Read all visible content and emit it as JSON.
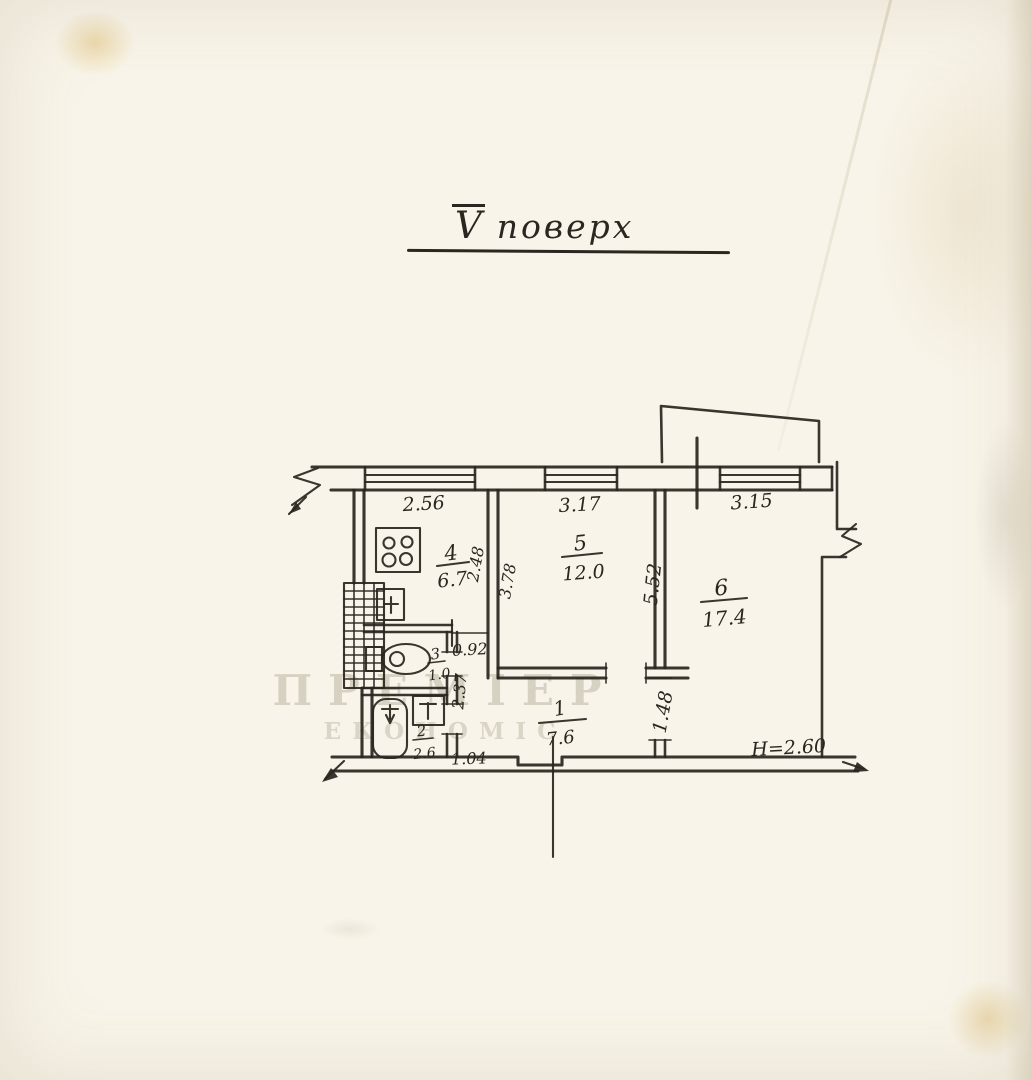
{
  "plan": {
    "floor_numeral": "V",
    "floor_word": "поверх",
    "rooms": {
      "r1": {
        "number": "1",
        "area": "7.6"
      },
      "r2": {
        "number": "2",
        "area": "2.6"
      },
      "r3": {
        "number": "3",
        "area": "1.0"
      },
      "r4": {
        "number": "4",
        "area": "6.7"
      },
      "r5": {
        "number": "5",
        "area": "12.0"
      },
      "r6": {
        "number": "6",
        "area": "17.4"
      }
    },
    "dims": {
      "win_kitchen": "2.56",
      "win_room5": "3.17",
      "win_room6": "3.15",
      "kitchen_depth": "2.48",
      "room5_depth": "3.78",
      "room6_side": "5.52",
      "door_room6": "1.48",
      "corridor_width": "0.92",
      "corridor_length": "2.37",
      "vestibule": "1.04",
      "ceiling_height": "H=2.60"
    },
    "watermark": {
      "line1": "ПРЕМІЕР",
      "line2": "ЕКОНОМІС"
    }
  },
  "colors": {
    "ink": "#2a2620",
    "paper": "#f8f4e9"
  }
}
